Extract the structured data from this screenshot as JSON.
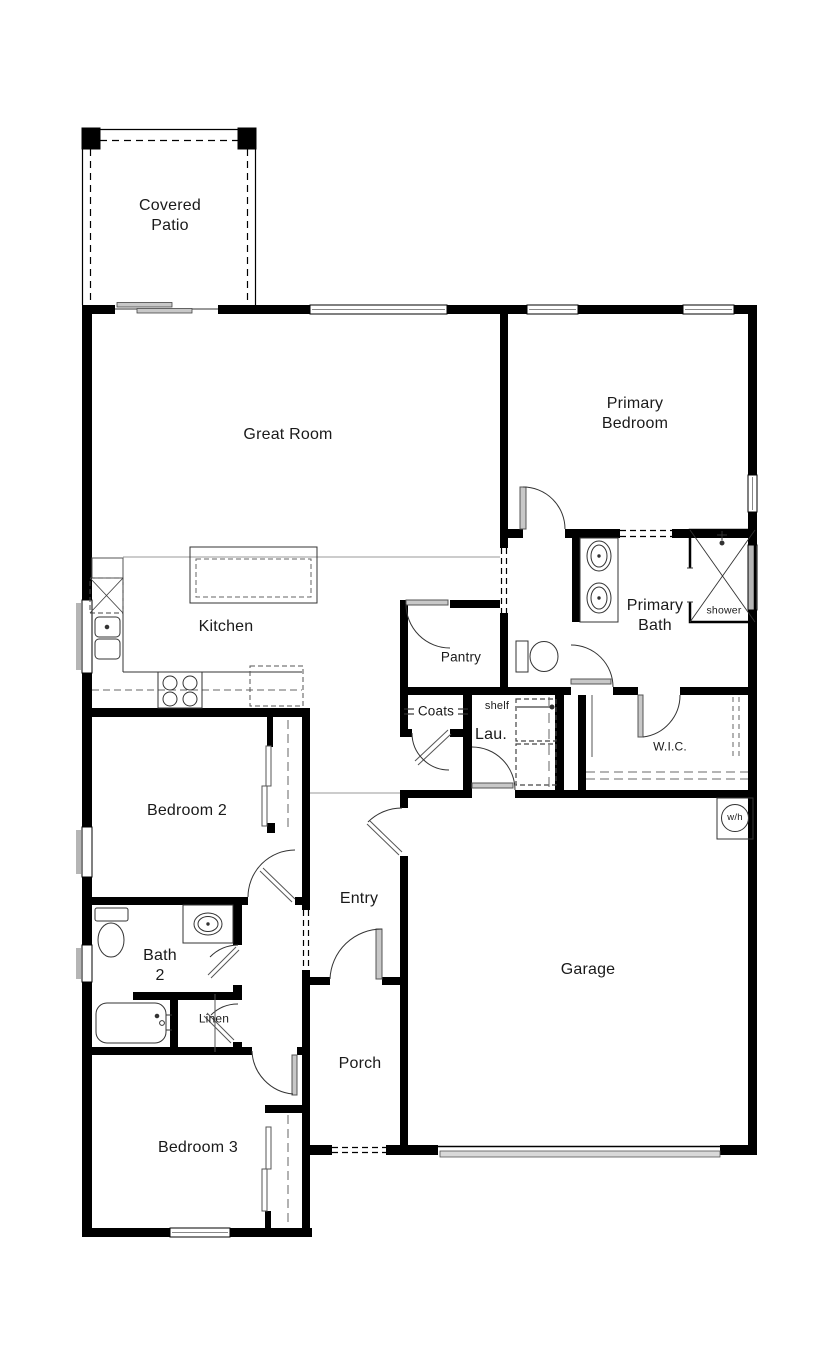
{
  "plan": {
    "type": "residential-floor-plan",
    "colors": {
      "wall": "#000000",
      "door_leaf": "#c8c8c8",
      "dashed": "#666666",
      "background": "#ffffff"
    },
    "labels": {
      "covered_patio": "Covered\nPatio",
      "great_room": "Great Room",
      "primary_bedroom": "Primary\nBedroom",
      "kitchen": "Kitchen",
      "pantry": "Pantry",
      "primary_bath": "Primary\nBath",
      "shower": "shower",
      "coats": "Coats",
      "shelf": "shelf",
      "laundry": "Lau.",
      "wic": "W.I.C.",
      "bedroom_2": "Bedroom 2",
      "entry": "Entry",
      "garage": "Garage",
      "bath_2": "Bath\n2",
      "linen": "Linen",
      "porch": "Porch",
      "bedroom_3": "Bedroom 3",
      "water_heater": "w/h"
    }
  }
}
